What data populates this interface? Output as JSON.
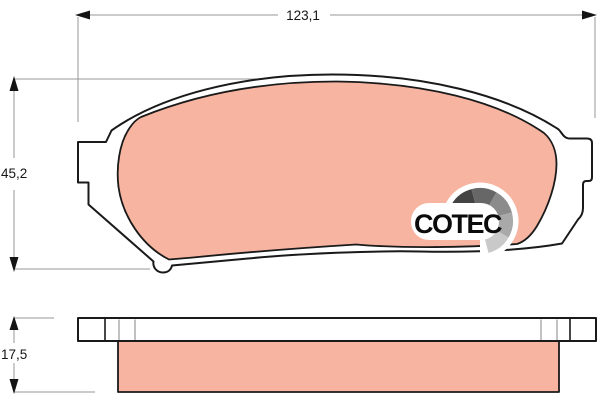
{
  "drawing": {
    "kind": "brake-pad-technical-drawing",
    "views": {
      "main": "pad-back-view",
      "bottom": "pad-side-view"
    }
  },
  "dims": {
    "width": "123,1",
    "height": "45,2",
    "thickness": "17,5"
  },
  "logo": {
    "text": "COTEC",
    "fan_colors": [
      "#000000",
      "#434343",
      "#676767",
      "#8b8b8b",
      "#a9a9a9",
      "#c9c9c9"
    ]
  },
  "colors": {
    "friction": "#f7b5a1",
    "outline": "#1a1a1a",
    "dimension": "#979797"
  }
}
